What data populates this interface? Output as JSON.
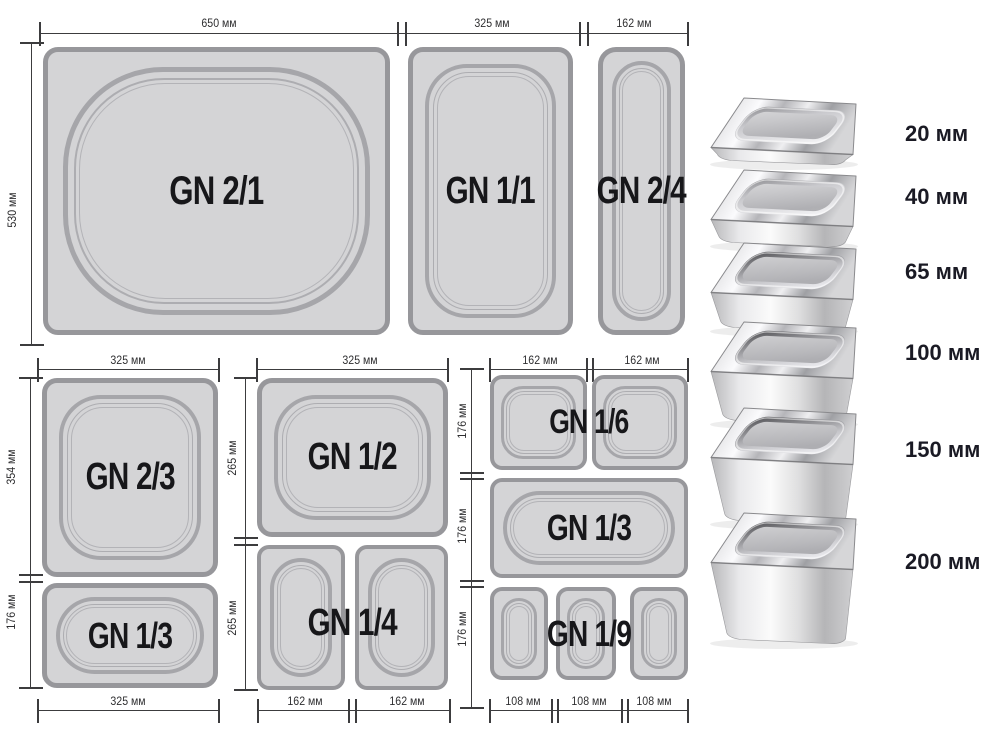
{
  "colors": {
    "pan_fill": "#d4d4d6",
    "pan_border": "#97979b",
    "ring": "#a6a6aa",
    "dim": "#3c3c3e",
    "text": "#17171a",
    "depth_text": "#1a1a24"
  },
  "diagram": {
    "top": {
      "dims": {
        "w650": "650 мм",
        "w325": "325 мм",
        "w162": "162 мм",
        "h530": "530 мм"
      },
      "pans": {
        "gn21": "GN 2/1",
        "gn11": "GN 1/1",
        "gn24": "GN 2/4"
      }
    },
    "bottom_left": {
      "dims": {
        "top_w": "325 мм",
        "h354": "354 мм",
        "h176": "176 мм",
        "bottom_w": "325 мм"
      },
      "pans": {
        "gn23": "GN 2/3",
        "gn13": "GN 1/3"
      }
    },
    "bottom_middle": {
      "dims": {
        "top_w": "325 мм",
        "h265a": "265 мм",
        "h265b": "265 мм",
        "bw162a": "162 мм",
        "bw162b": "162 мм"
      },
      "pans": {
        "gn12": "GN 1/2",
        "gn14": "GN 1/4"
      }
    },
    "bottom_right": {
      "dims": {
        "tw162a": "162 мм",
        "tw162b": "162 мм",
        "h176a": "176 мм",
        "h176b": "176 мм",
        "h176c": "176 мм",
        "bw108a": "108 мм",
        "bw108b": "108 мм",
        "bw108c": "108 мм"
      },
      "pans": {
        "gn16": "GN 1/6",
        "gn13": "GN 1/3",
        "gn19": "GN 1/9"
      }
    }
  },
  "depth_scale": {
    "items": [
      {
        "label": "20 мм",
        "depth_mm": 20
      },
      {
        "label": "40 мм",
        "depth_mm": 40
      },
      {
        "label": "65 мм",
        "depth_mm": 65
      },
      {
        "label": "100 мм",
        "depth_mm": 100
      },
      {
        "label": "150 мм",
        "depth_mm": 150
      },
      {
        "label": "200 мм",
        "depth_mm": 200
      }
    ]
  }
}
